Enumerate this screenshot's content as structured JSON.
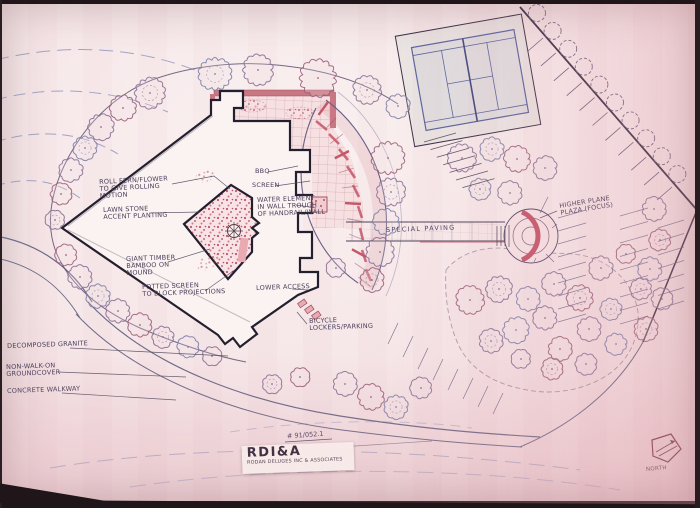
{
  "plan": {
    "annotations": {
      "roll_fern": "ROLL FERN/FLOWER\nTO GIVE ROLLING\nMOTION",
      "lawn_stone": "LAWN STONE\nACCENT PLANTING",
      "giant_timber": "GIANT TIMBER\nBAMBOO ON\nMOUND",
      "potted_screen": "POTTED SCREEN\nTO BLOCK PROJECTIONS",
      "bbq": "BBQ",
      "screen": "SCREEN",
      "water_element": "WATER ELEMENT\nIN WALL TROUGH\nOF HANDRAIL/WALL",
      "special_paving": "SPECIAL PAVING",
      "higher_plaza": "HIGHER PLANE\nPLAZA (FOCUS)",
      "lower_access": "LOWER ACCESS",
      "bicycle_lockers": "BICYCLE\nLOCKERS/PARKING",
      "decomposed_granite": "DECOMPOSED GRANITE",
      "groundcover": "NON-WALK-ON\nGROUNDCOVER",
      "concrete_walkway": "CONCRETE WALKWAY",
      "north": "NORTH"
    },
    "sheet_number": "# 91/052.1",
    "title_block": {
      "logo": "RDI&A",
      "firm_line": "RODAN DELUGES INC & ASSOCIATES"
    },
    "colors": {
      "paper": "#f5e4e6",
      "ink": "#453c56",
      "pencil_blue": "#8a90ba",
      "marker_red": "#c4566a",
      "marker_pink": "#eec3c9"
    }
  }
}
